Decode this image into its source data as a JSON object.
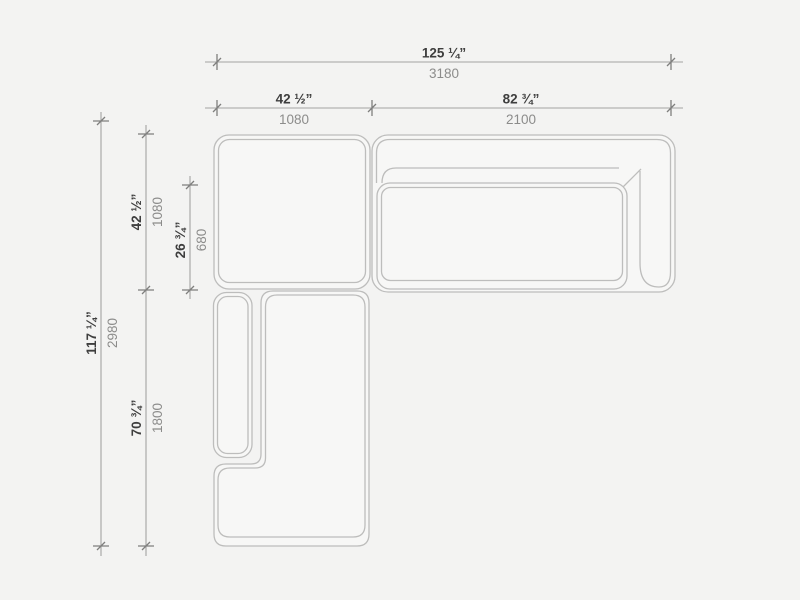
{
  "diagram": {
    "type": "sectional-sofa-floor-plan",
    "dimensions": {
      "total_width": {
        "inches": "125 ¼”",
        "mm": "3180"
      },
      "corner_width": {
        "inches": "42 ½”",
        "mm": "1080"
      },
      "sofa_width": {
        "inches": "82 ¾”",
        "mm": "2100"
      },
      "total_depth": {
        "inches": "117 ¼”",
        "mm": "2980"
      },
      "corner_depth": {
        "inches": "42 ½”",
        "mm": "1080"
      },
      "seat_depth": {
        "inches": "26 ¾”",
        "mm": "680"
      },
      "chaise_length": {
        "inches": "70 ¾”",
        "mm": "1800"
      }
    },
    "colors": {
      "background": "#f3f3f2",
      "module_fill": "#f7f7f6",
      "module_outline": "#bdbdbc",
      "dimension_line": "#a3a3a2",
      "tick": "#7f7f7e",
      "inch_text": "#3e3e3e",
      "mm_text": "#8c8c8b"
    }
  }
}
